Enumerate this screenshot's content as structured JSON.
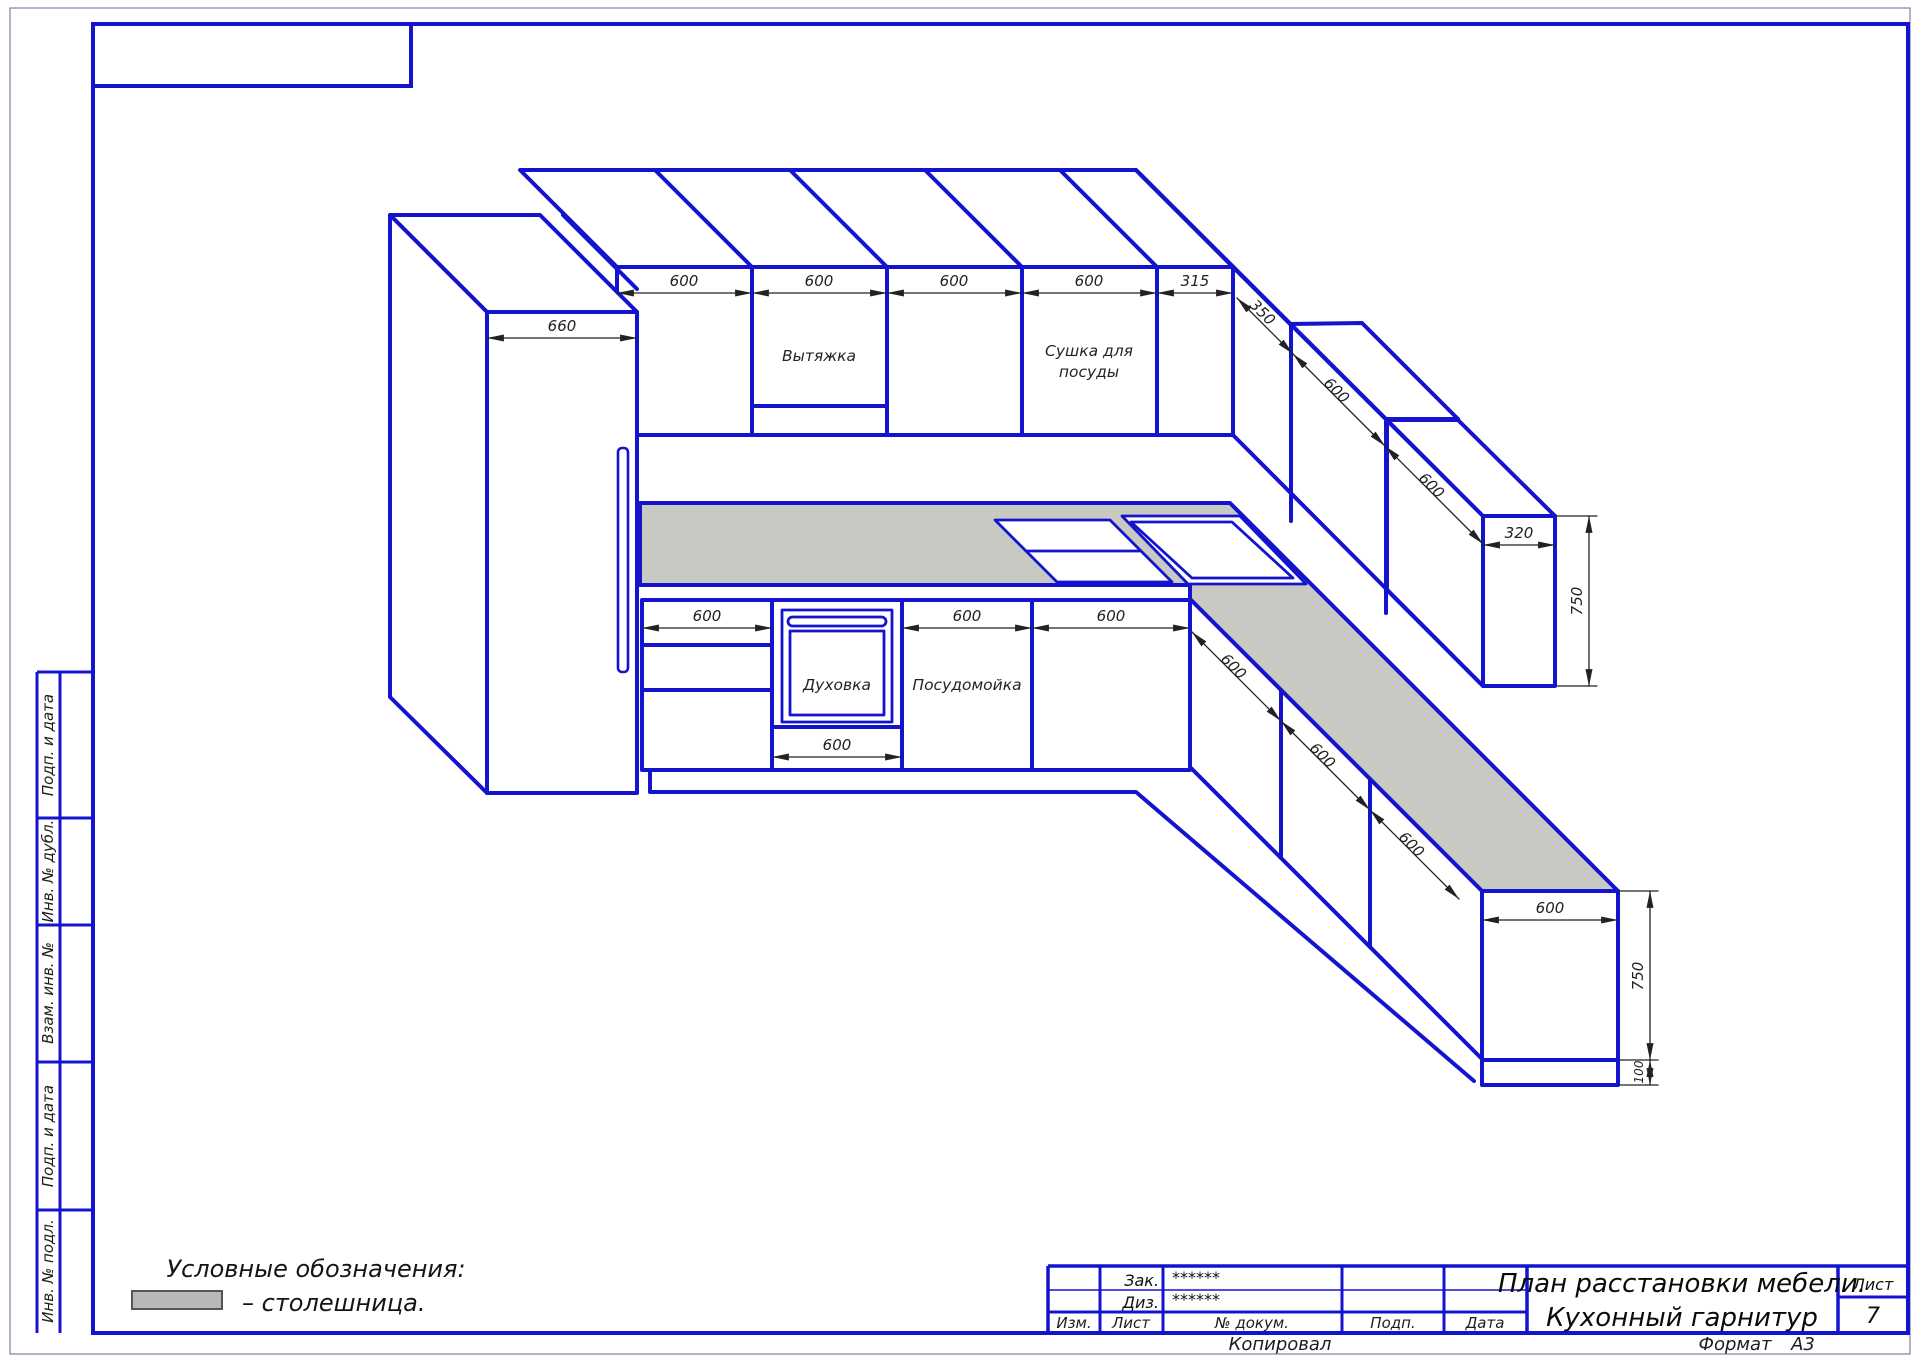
{
  "colors": {
    "line_blue": "#1414cf",
    "countertop_gray": "#c9c9c3",
    "legend_swatch_gray": "#b8b8b8",
    "dim_color": "#222222"
  },
  "drawing": {
    "labels": {
      "hood": "Вытяжка",
      "dryer_line1": "Сушка для",
      "dryer_line2": "посуды",
      "oven": "Духовка",
      "dishwasher": "Посудомойка"
    },
    "dimensions": {
      "fridge_width": "660",
      "upper_row": [
        "600",
        "600",
        "600",
        "600",
        "315"
      ],
      "upper_right_run": [
        "350",
        "600",
        "600"
      ],
      "upper_end_width": "320",
      "upper_end_height": "750",
      "base_row": [
        "600",
        "600",
        "600"
      ],
      "oven_width": "600",
      "base_right_run": [
        "600",
        "600",
        "600"
      ],
      "base_end_width": "600",
      "base_end_height": "750",
      "base_plinth_height": "100"
    }
  },
  "legend": {
    "heading": "Условные обозначения:",
    "item_label": "– столешница."
  },
  "side_stamp": {
    "cells": [
      "Подп. и дата",
      "Инв. № дубл.",
      "Взам. инв. №",
      "Подп. и дата",
      "Инв. № подл."
    ]
  },
  "title_block": {
    "customer_label": "Зак.",
    "customer_value": "******",
    "designer_label": "Диз.",
    "designer_value": "******",
    "columns": [
      "Изм.",
      "Лист",
      "№ докум.",
      "Подп.",
      "Дата"
    ],
    "title_line1": "План расстановки мебели.",
    "title_line2": "Кухонный гарнитур",
    "sheet_label": "Лист",
    "sheet_number": "7",
    "footer": {
      "copied": "Копировал",
      "format_label": "Формат",
      "format_value": "А3"
    }
  }
}
